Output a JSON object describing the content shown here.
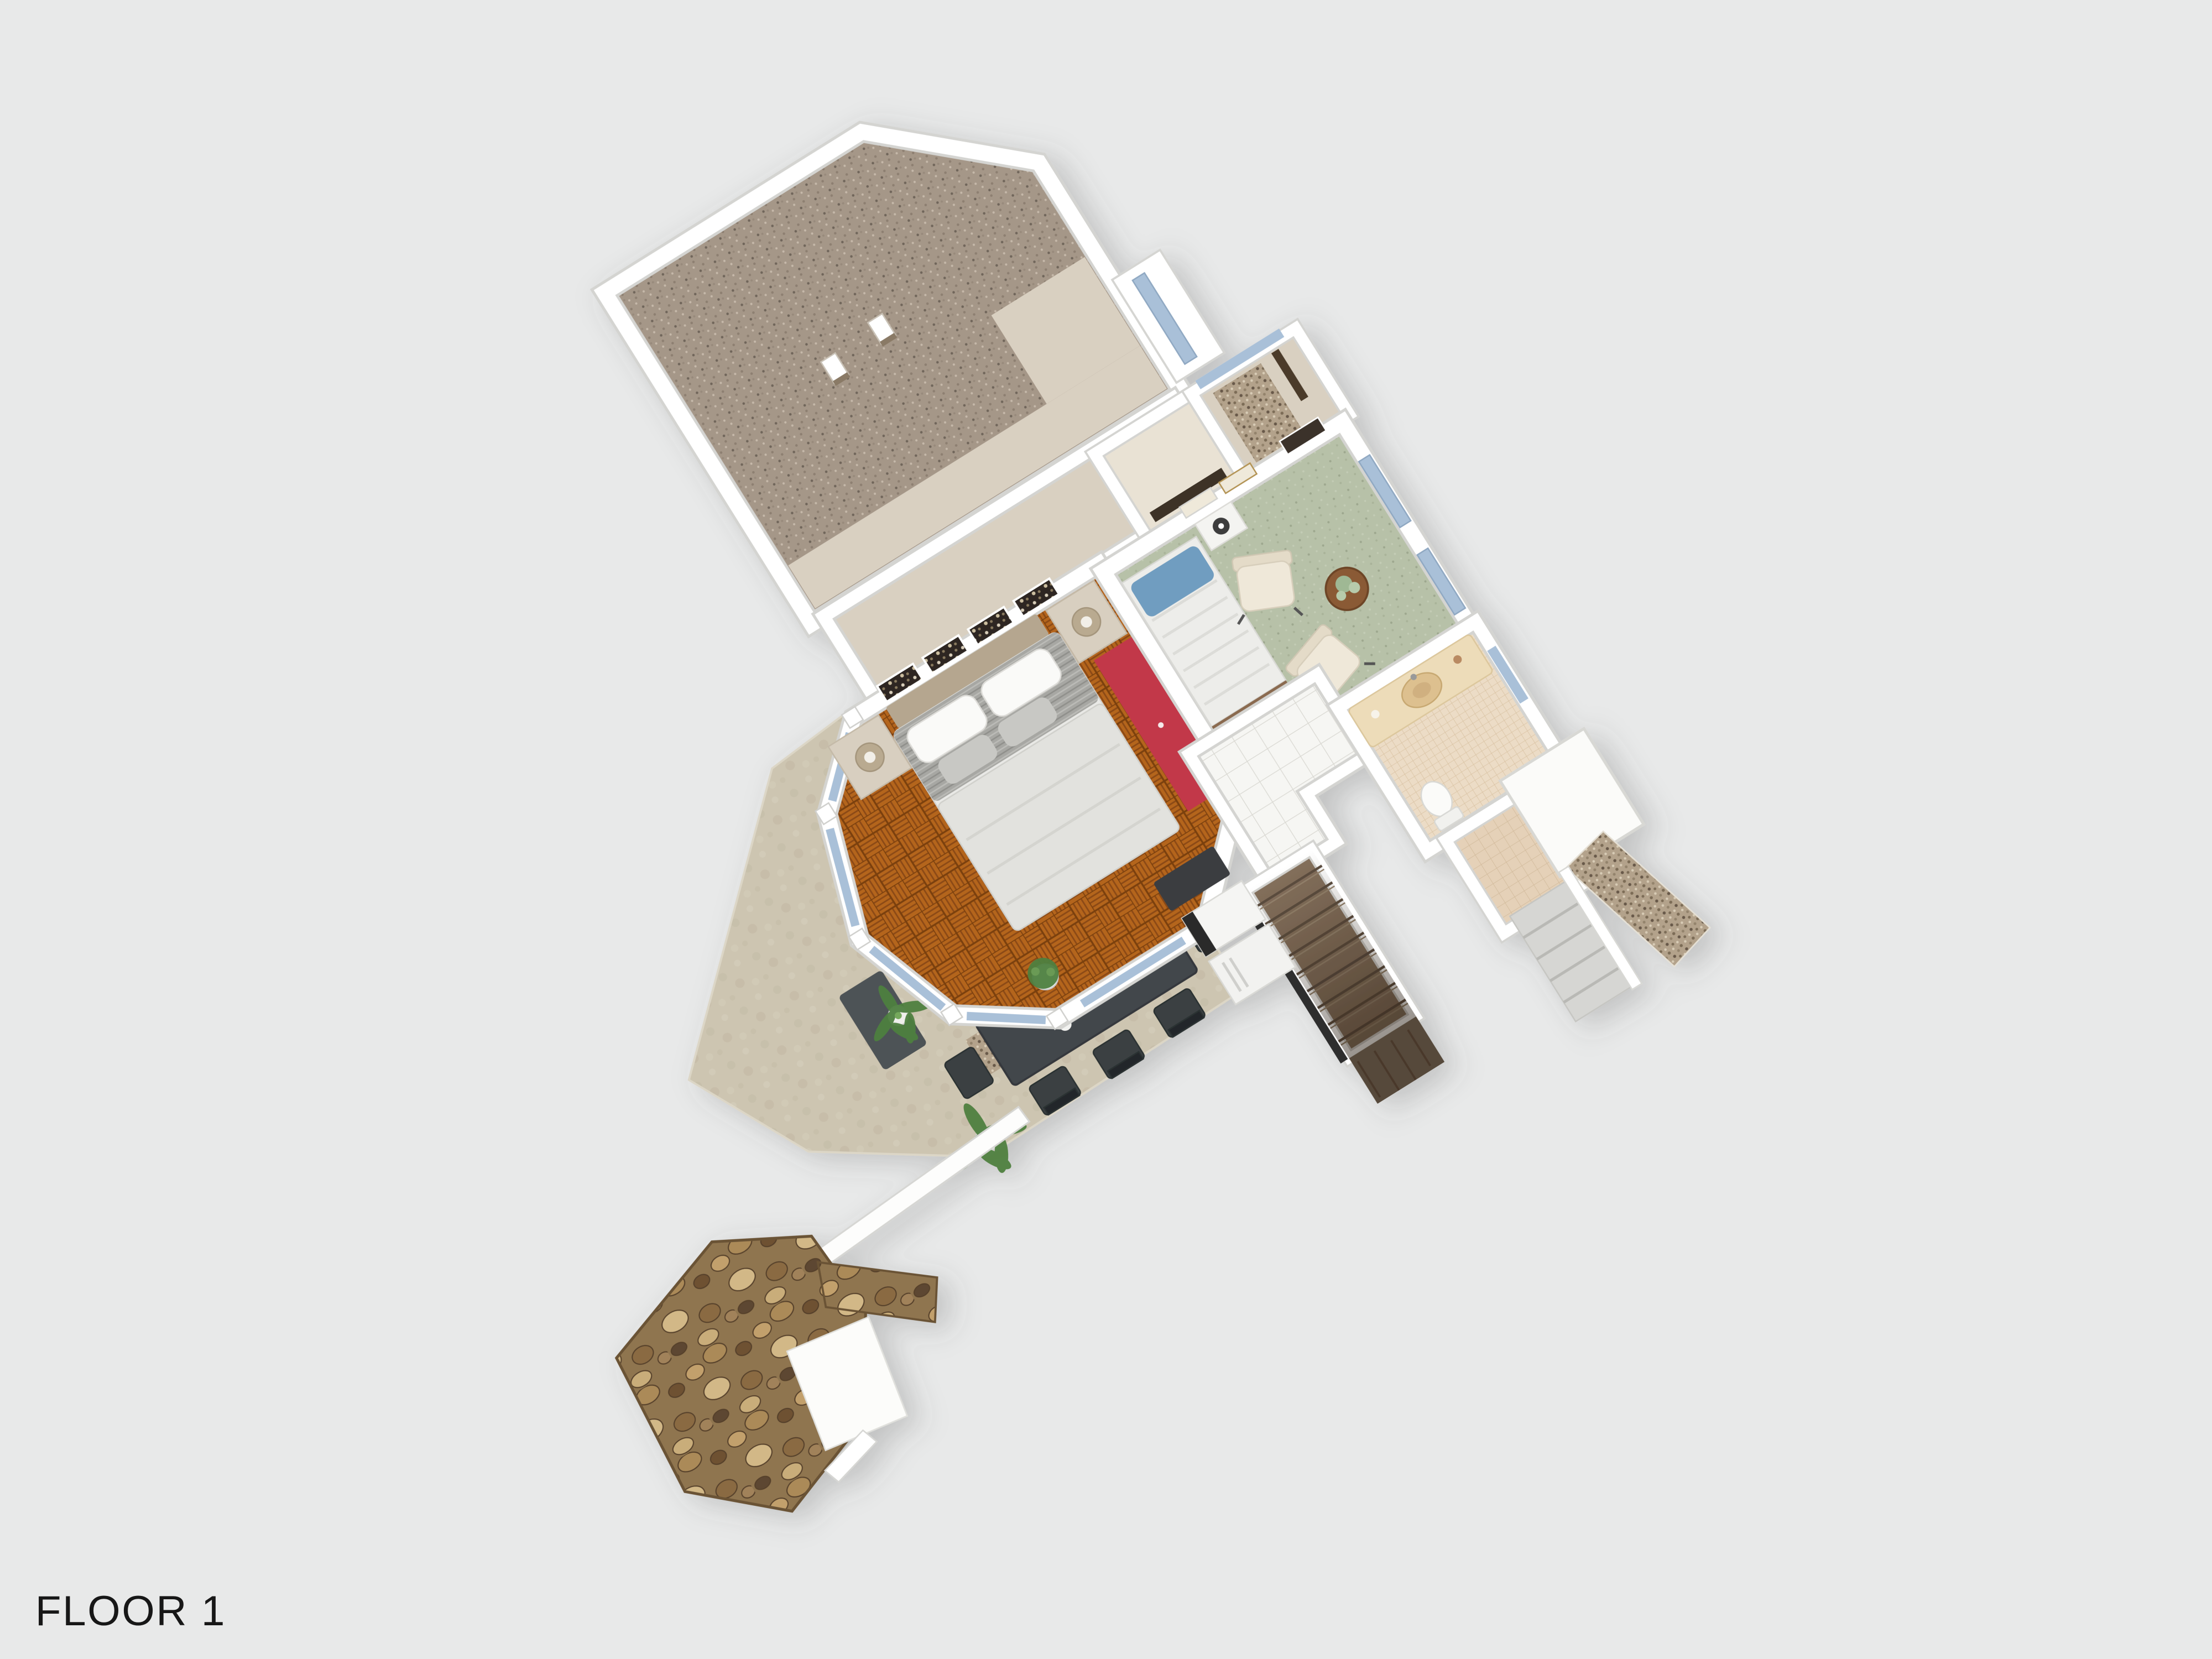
{
  "title": "FLOOR 1",
  "scene": {
    "background": "#e8e9e9",
    "view": "3d-top-down-floor-plan"
  },
  "palette": {
    "background": "#e8e9e9",
    "wall": "#ffffff",
    "wall_edge": "#d4d4d1",
    "carpet_taupe": "#a59788",
    "tan_floor": "#d9d0c1",
    "parquet": "#b4651f",
    "parquet_dark": "#8b4a12",
    "green_carpet": "#b7c1a8",
    "tile_white": "#f6f6f3",
    "mosaic_beige": "#ecdcc6",
    "walkin_beige": "#e5d1b8",
    "concrete": "#cdc5b1",
    "gravel": "#b3a28b",
    "stone_base": "#8f744f",
    "stair_wood": "#84705c",
    "dark_wood": "#57493a",
    "glass_blue": "#a9c0d8",
    "wardrobe_red": "#c23748",
    "pillow_blue": "#6f9dc0",
    "table_charcoal": "#42474b",
    "chair_cream": "#efe8d9",
    "plant_green": "#4e8040",
    "label_color": "#171717"
  },
  "rooms": [
    {
      "id": "bonus-room",
      "floor": "taupe-speckled-carpet"
    },
    {
      "id": "upper-hallway",
      "floor": "tan"
    },
    {
      "id": "master-bedroom",
      "floor": "orange-parquet"
    },
    {
      "id": "bay-windows",
      "floor": "white-frames-blue-glass"
    },
    {
      "id": "green-bedroom",
      "floor": "sage-green-carpet"
    },
    {
      "id": "closet",
      "floor": "tan"
    },
    {
      "id": "entry-hall",
      "floor": "tan-with-gravel-mat"
    },
    {
      "id": "tiled-hallway",
      "floor": "white-tile"
    },
    {
      "id": "bathroom",
      "floor": "beige-mosaic"
    },
    {
      "id": "walk-in",
      "floor": "beige-tile"
    },
    {
      "id": "staircase",
      "floor": "brown-wood-treads"
    },
    {
      "id": "dining-terrace",
      "floor": "concrete"
    },
    {
      "id": "entry-porch",
      "floor": "gravel-and-steps"
    },
    {
      "id": "stone-canopy",
      "floor": "rubble-stone"
    }
  ],
  "furniture": [
    {
      "id": "double-bed"
    },
    {
      "id": "nightstand-lamp-left"
    },
    {
      "id": "nightstand-lamp-right"
    },
    {
      "id": "red-wardrobe"
    },
    {
      "id": "wall-art-panels"
    },
    {
      "id": "single-bed-blue-pillow"
    },
    {
      "id": "fan-side-table"
    },
    {
      "id": "armchair-1"
    },
    {
      "id": "armchair-2"
    },
    {
      "id": "round-side-table"
    },
    {
      "id": "dining-table"
    },
    {
      "id": "dining-chairs",
      "count": 8
    },
    {
      "id": "kitchen-appliances"
    },
    {
      "id": "vanity-sink"
    },
    {
      "id": "toilet"
    },
    {
      "id": "potted-plant-bay"
    },
    {
      "id": "palm-plant-1"
    },
    {
      "id": "palm-plant-2"
    },
    {
      "id": "structural-columns",
      "count": 2
    },
    {
      "id": "doormats"
    }
  ]
}
